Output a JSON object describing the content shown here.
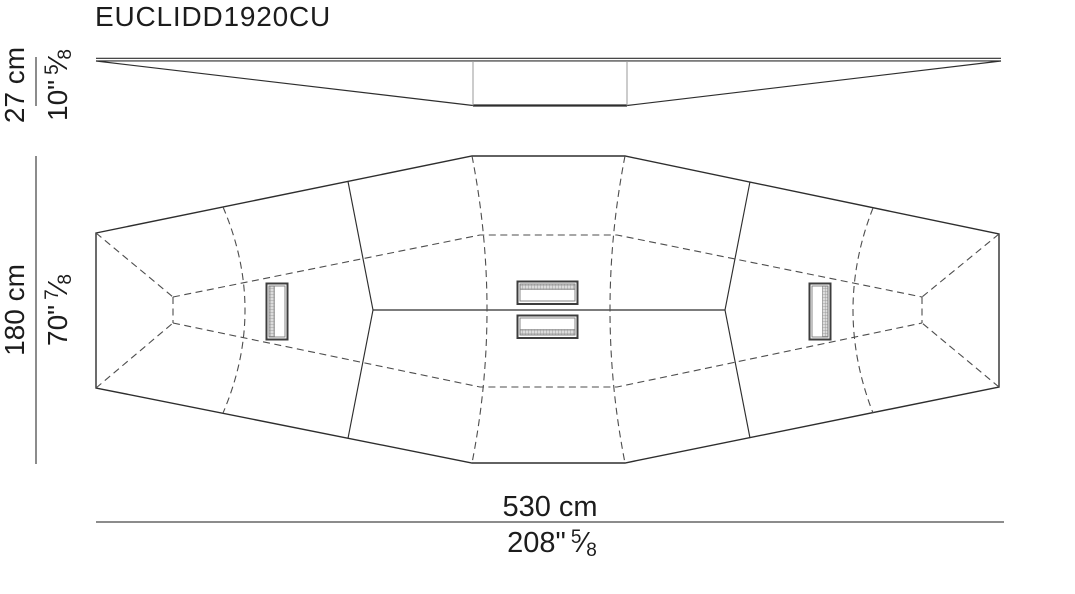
{
  "title": "EUCLIDD1920CU",
  "dimensions": {
    "height": {
      "cm_label": "27 cm",
      "inch_label": "10\"",
      "fraction": {
        "numerator": "5",
        "slash": "⁄",
        "denominator": "8"
      }
    },
    "depth": {
      "cm_label": "180 cm",
      "inch_label": "70\"",
      "fraction": {
        "numerator": "7",
        "slash": "⁄",
        "denominator": "8"
      }
    },
    "width": {
      "cm_label": "530 cm",
      "inch_label": "208\"",
      "fraction": {
        "numerator": "5",
        "slash": "⁄",
        "denominator": "8"
      }
    }
  },
  "colors": {
    "line": "#2e2e2e",
    "hidden_line": "#4d4d4d",
    "dimension_line": "#8c8c8c",
    "text": "#1c1c1c",
    "background": "#ffffff"
  }
}
